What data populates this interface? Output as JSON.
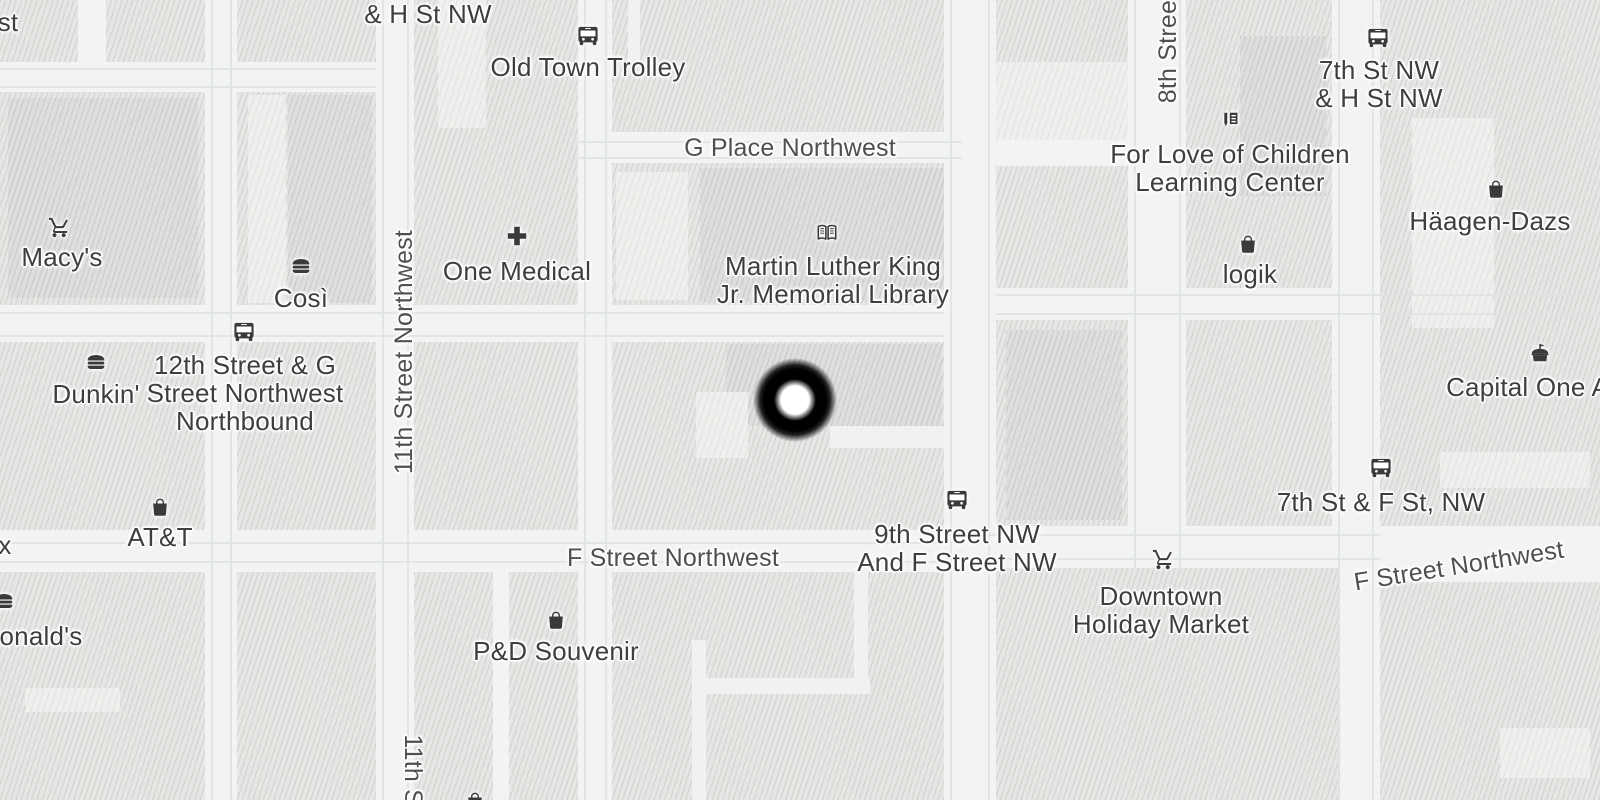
{
  "map": {
    "marker": {
      "x": 795,
      "y": 400
    },
    "colors": {
      "street": "#f2f3f2",
      "block": "#e6e6e4",
      "building_dark": "#dedfdd",
      "building_light": "#efefed",
      "casing": "#dde3e1",
      "poi_text": "#3e3e3e",
      "street_text": "#4f4f4f",
      "icon": "#3a3a3a",
      "halo": "#ffffff",
      "marker": "#000000"
    },
    "street_labels": [
      {
        "id": "g-place-northwest",
        "text": "G Place Northwest",
        "x": 790,
        "y": 148,
        "rotate": 0
      },
      {
        "id": "f-street-northwest-west",
        "text": "F Street Northwest",
        "x": 673,
        "y": 558,
        "rotate": 0
      },
      {
        "id": "f-street-northwest-east",
        "text": "F Street Northwest",
        "x": 1459,
        "y": 566,
        "rotate": -9
      },
      {
        "id": "11th-street-northwest",
        "text": "11th Street Northwest",
        "x": 404,
        "y": 352,
        "rotate": -90
      },
      {
        "id": "8th-street",
        "text": "8th Street",
        "x": 1168,
        "y": 48,
        "rotate": -90
      },
      {
        "id": "11th-street-partial-bottom",
        "text": "11th Str",
        "x": 413,
        "y": 778,
        "rotate": 90
      }
    ],
    "pois": [
      {
        "id": "partial-st",
        "icon": null,
        "lines": [
          "st"
        ],
        "label_x": 8,
        "label_y": 22
      },
      {
        "id": "h-st-nw-partial",
        "icon": null,
        "lines": [
          "& H St NW"
        ],
        "label_x": 428,
        "label_y": 14
      },
      {
        "id": "old-town-trolley",
        "icon": "bus",
        "icon_x": 588,
        "icon_y": 36,
        "lines": [
          "Old Town Trolley"
        ],
        "label_x": 588,
        "label_y": 67
      },
      {
        "id": "macys",
        "icon": "cart",
        "icon_x": 59,
        "icon_y": 228,
        "lines": [
          "Macy's"
        ],
        "label_x": 62,
        "label_y": 257
      },
      {
        "id": "cosi",
        "icon": "burger",
        "icon_x": 301,
        "icon_y": 266,
        "lines": [
          "Così"
        ],
        "label_x": 301,
        "label_y": 298
      },
      {
        "id": "one-medical",
        "icon": "cross",
        "icon_x": 517,
        "icon_y": 236,
        "lines": [
          "One Medical"
        ],
        "label_x": 517,
        "label_y": 271
      },
      {
        "id": "mlk-memorial-library",
        "icon": "book",
        "icon_x": 827,
        "icon_y": 233,
        "lines": [
          "Martin Luther King",
          "Jr. Memorial Library"
        ],
        "label_x": 833,
        "label_y": 280
      },
      {
        "id": "dunkin",
        "icon": "burger",
        "icon_x": 96,
        "icon_y": 362,
        "lines": [
          "Dunkin'"
        ],
        "label_x": 96,
        "label_y": 394
      },
      {
        "id": "bus-stop-12th-g",
        "icon": "bus",
        "icon_x": 244,
        "icon_y": 332,
        "lines": [
          "12th Street & G",
          "Street Northwest",
          "Northbound"
        ],
        "label_x": 245,
        "label_y": 393
      },
      {
        "id": "att",
        "icon": "bag",
        "icon_x": 160,
        "icon_y": 507,
        "lines": [
          "AT&T"
        ],
        "label_x": 160,
        "label_y": 537
      },
      {
        "id": "partial-x",
        "icon": null,
        "lines": [
          "x"
        ],
        "label_x": 5,
        "label_y": 545
      },
      {
        "id": "mcdonalds-partial",
        "icon": "burger",
        "icon_x": 4,
        "icon_y": 601,
        "lines": [
          "McDonald's"
        ],
        "label_x": 14,
        "label_y": 636
      },
      {
        "id": "pd-souvenir",
        "icon": "bag",
        "icon_x": 556,
        "icon_y": 620,
        "lines": [
          "P&D Souvenir"
        ],
        "label_x": 556,
        "label_y": 651
      },
      {
        "id": "bus-stop-9th-f",
        "icon": "bus",
        "icon_x": 957,
        "icon_y": 500,
        "lines": [
          "9th Street NW",
          "And F Street NW"
        ],
        "label_x": 957,
        "label_y": 548
      },
      {
        "id": "downtown-holiday-market",
        "icon": "cart",
        "icon_x": 1163,
        "icon_y": 560,
        "lines": [
          "Downtown",
          "Holiday Market"
        ],
        "label_x": 1161,
        "label_y": 610
      },
      {
        "id": "for-love-of-children",
        "icon": "education",
        "icon_x": 1230,
        "icon_y": 121,
        "lines": [
          "For Love of Children",
          "Learning Center"
        ],
        "label_x": 1230,
        "label_y": 168
      },
      {
        "id": "logik",
        "icon": "bag",
        "icon_x": 1248,
        "icon_y": 244,
        "lines": [
          "logik"
        ],
        "label_x": 1250,
        "label_y": 274
      },
      {
        "id": "bus-stop-7th-h",
        "icon": "bus",
        "icon_x": 1378,
        "icon_y": 38,
        "lines": [
          "7th St NW",
          "& H St NW"
        ],
        "label_x": 1379,
        "label_y": 84
      },
      {
        "id": "haagen-dazs",
        "icon": "bag",
        "icon_x": 1496,
        "icon_y": 189,
        "lines": [
          "Häagen-Dazs"
        ],
        "label_x": 1490,
        "label_y": 221
      },
      {
        "id": "capital-one-arena",
        "icon": "arena",
        "icon_x": 1540,
        "icon_y": 354,
        "lines": [
          "Capital One Arena"
        ],
        "label_x": 1554,
        "label_y": 387
      },
      {
        "id": "bus-stop-7th-f",
        "icon": "bus",
        "icon_x": 1381,
        "icon_y": 468,
        "lines": [
          "7th St & F St, NW"
        ],
        "label_x": 1381,
        "label_y": 502
      },
      {
        "id": "partial-poi-bottom",
        "icon": "bag",
        "icon_x": 475,
        "icon_y": 801,
        "lines": [],
        "label_x": 475,
        "label_y": 810
      }
    ]
  }
}
